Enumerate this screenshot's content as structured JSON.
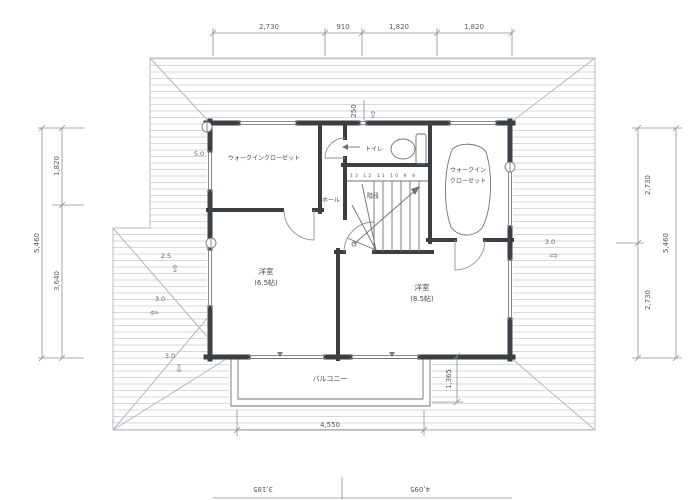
{
  "dims": {
    "top": [
      "2,730",
      "910",
      "1,820",
      "1,820"
    ],
    "left_total": "5,460",
    "left_segments": [
      "1,820",
      "3,640"
    ],
    "right_total": "5,460",
    "right_segments": [
      "2,730",
      "2,730"
    ],
    "balcony_width": "4,550",
    "balcony_depth": "1,365",
    "bottom_left": "3,185",
    "bottom_right": "4,095",
    "small_top": "250"
  },
  "labels": {
    "wic_left": "ウォークインクローゼット",
    "toilet": "トイレ",
    "stairs": "階段",
    "stair_numbers": "13 12 11 10 9 8",
    "hall": "ホール",
    "wic_right_1": "ウォークイン",
    "wic_right_2": "クローゼット",
    "bedroom_left_name": "洋室",
    "bedroom_left_size": "(6.5帖)",
    "bedroom_right_name": "洋室",
    "bedroom_right_size": "(8.5帖)",
    "balcony": "バルコニー"
  },
  "roof": {
    "pitch_left_top": "2.5",
    "pitch_left_mid": "3.0",
    "pitch_left_bottom": "3.0",
    "pitch_right": "3.0",
    "pitch_top_left": "5.0",
    "arrow_up": "⇧",
    "arrow_left": "⇦",
    "arrow_down": "⇩",
    "arrow_right": "⇨"
  },
  "colors": {
    "wall": "#3b3e42",
    "roof_hatch": "#cfd5da",
    "dim_line": "#8a8f94",
    "text": "#55595d"
  }
}
